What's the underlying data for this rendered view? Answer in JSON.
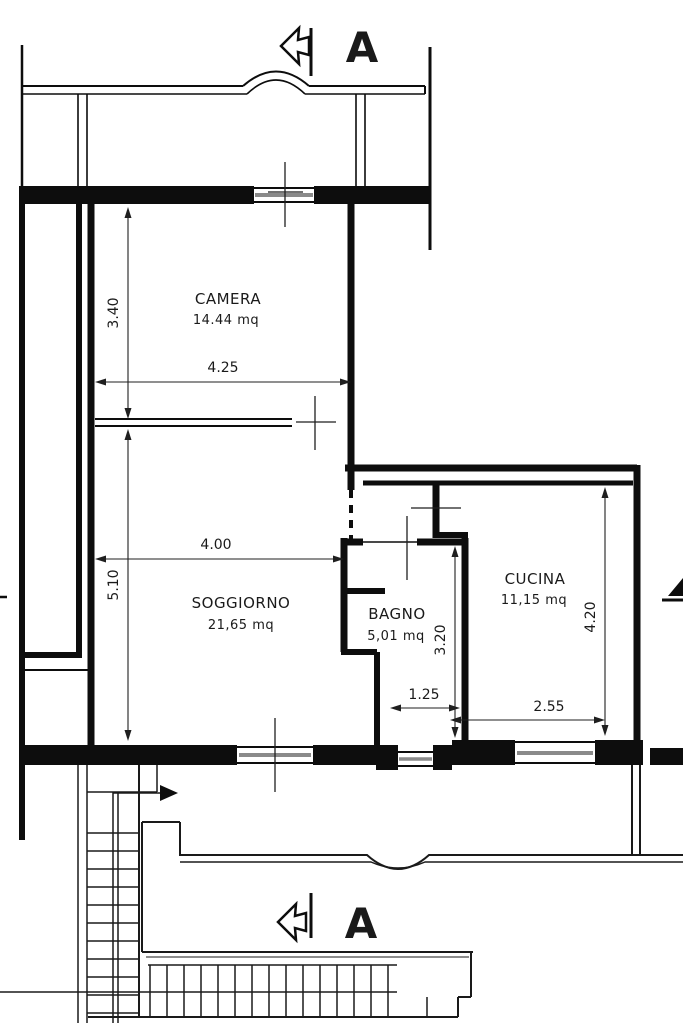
{
  "plan": {
    "title": "apartment floor plan",
    "section_markers": {
      "top_label": "A",
      "bottom_label": "A"
    },
    "icons": {
      "section_cut": "hollow-left-arrow-icon",
      "stair_direction": "solid-right-arrow-icon"
    },
    "rooms": [
      {
        "id": "camera",
        "name": "CAMERA",
        "area": "14.44  mq"
      },
      {
        "id": "soggiorno",
        "name": "SOGGIORNO",
        "area": "21,65  mq"
      },
      {
        "id": "bagno",
        "name": "BAGNO",
        "area": "5,01  mq"
      },
      {
        "id": "cucina",
        "name": "CUCINA",
        "area": "11,15  mq"
      }
    ],
    "dimensions": {
      "camera_height": "3.40",
      "camera_width": "4.25",
      "soggiorno_width": "4.00",
      "soggiorno_height": "5.10",
      "bagno_height": "3.20",
      "bagno_width": "1.25",
      "cucina_width": "2.55",
      "cucina_height": "4.20"
    },
    "colors": {
      "line": "#0d0d0d",
      "glazing": "#8a8a8a"
    }
  }
}
